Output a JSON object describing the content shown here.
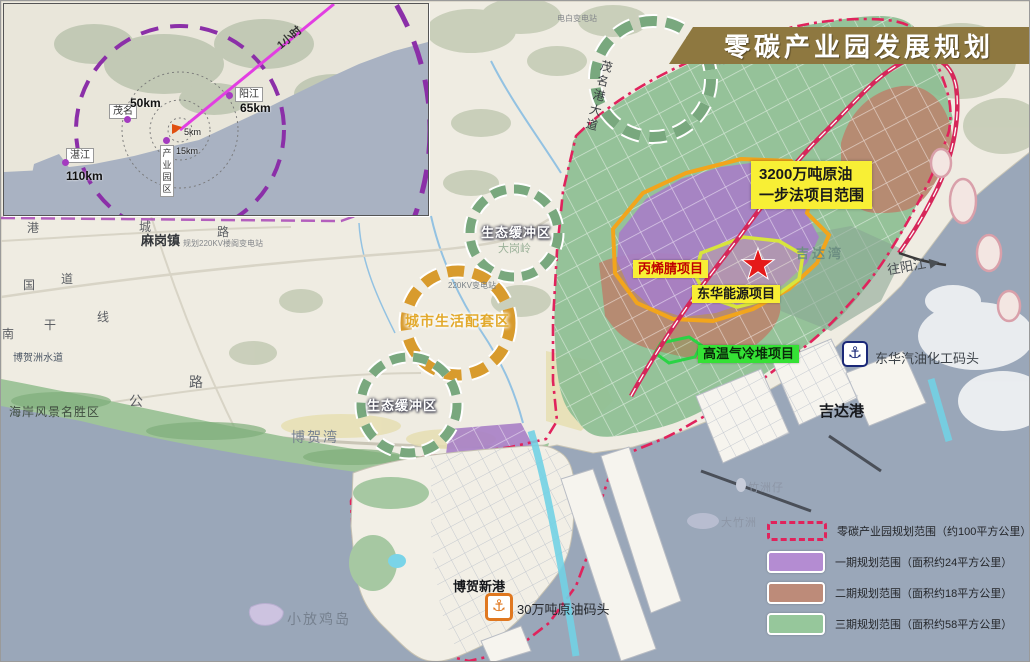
{
  "title": {
    "banner": "零碳产业园发展规划"
  },
  "inset": {
    "cities": [
      {
        "name": "茂名",
        "distance": "50km"
      },
      {
        "name": "阳江",
        "distance": "65km"
      },
      {
        "name": "湛江",
        "distance": "110km"
      }
    ],
    "park_label": "产业园区",
    "ring_5km": "5km",
    "ring_15km": "15km",
    "travel_time": "1小时"
  },
  "projects": {
    "range_line1": "3200万吨原油",
    "range_line2": "一步法项目范围",
    "acrylonitrile": "丙烯腈项目",
    "donghua_energy": "东华能源项目",
    "htgr": "高温气冷堆项目"
  },
  "places": {
    "donghua_wharf": "东华汽油化工码头",
    "jida_port": "吉达港",
    "jida_bay": "吉达湾",
    "to_yangjiang": "往阳江",
    "bohe_new_port": "博贺新港",
    "crude_oil_wharf": "30万吨原油码头",
    "xiaofangji_island": "小放鸡岛",
    "bohe_bay": "博贺湾",
    "magang_town": "麻岗镇",
    "magang_substation": "规划220KV楼阁变电站",
    "dianbai_substation": "电白变电站",
    "substation_220kv": "220KV变电站",
    "lingmen_town": "岭门镇",
    "zhuzhouzai": "竹洲仔",
    "dazhuzhou": "大竹洲",
    "dagangling": "大岗岭",
    "bohezhou_waterway": "博贺洲水道",
    "coastal_scenic": "海岸风景名胜区"
  },
  "zones": {
    "eco_buffer_north": "生态缓冲区",
    "eco_buffer_south": "生态缓冲区",
    "city_living": "城市生活配套区"
  },
  "roads": {
    "maoming_port_avenue": "茂名港大道",
    "gang": "港",
    "cheng": "城",
    "lu": "路",
    "guo": "国",
    "dao": "道",
    "gan": "干",
    "xian": "线",
    "nan": "南",
    "gong": "公",
    "lu2": "路"
  },
  "legend": {
    "items": [
      {
        "label": "零碳产业园规划范围（约100平方公里）"
      },
      {
        "label": "一期规划范围（面积约24平方公里）"
      },
      {
        "label": "二期规划范围（面积约18平方公里）"
      },
      {
        "label": "三期规划范围（面积约58平方公里）"
      }
    ]
  },
  "colors": {
    "banner_gold": "#8e7840",
    "boundary_red": "#e0235c",
    "phase1_purple": "#b48cd2",
    "phase2_brown": "#bd8b79",
    "phase3_green": "#96c79b",
    "highlight_yellow": "#f8ef35",
    "highlight_green": "#35e135",
    "sea_blue": "#9aa7b9",
    "ring_purple": "#8b2fa8"
  }
}
